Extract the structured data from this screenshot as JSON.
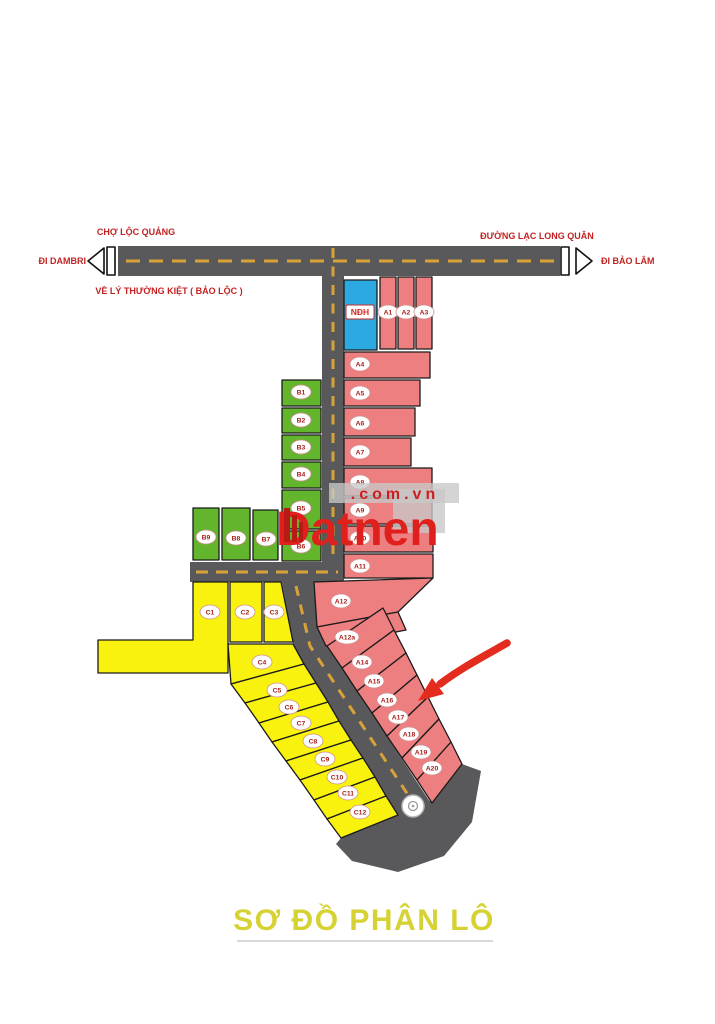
{
  "page_title": "SƠ ĐỒ PHÂN LÔ",
  "watermark": {
    "brand": "Datnen",
    "suffix": ".com.vn"
  },
  "streets": {
    "market": "CHỢ LỘC QUẢNG",
    "main_road": "ĐƯỜNG LẠC LONG QUÂN",
    "west_direction": "ĐI DAMBRI",
    "east_direction": "ĐI BẢO LÂM",
    "south_note": "VỀ LÝ THƯỜNG KIỆT ( BẢO LỘC )"
  },
  "plots": {
    "blue": [
      {
        "id": "NDH",
        "label": "NĐH"
      }
    ],
    "pink": [
      {
        "id": "A1",
        "label": "A1"
      },
      {
        "id": "A2",
        "label": "A2"
      },
      {
        "id": "A3",
        "label": "A3"
      },
      {
        "id": "A4",
        "label": "A4"
      },
      {
        "id": "A5",
        "label": "A5"
      },
      {
        "id": "A6",
        "label": "A6"
      },
      {
        "id": "A7",
        "label": "A7"
      },
      {
        "id": "A8",
        "label": "A8"
      },
      {
        "id": "A9",
        "label": "A9"
      },
      {
        "id": "A10",
        "label": "A10"
      },
      {
        "id": "A11",
        "label": "A11"
      },
      {
        "id": "A12",
        "label": "A12"
      },
      {
        "id": "A12a",
        "label": "A12a"
      },
      {
        "id": "A14",
        "label": "A14"
      },
      {
        "id": "A15",
        "label": "A15"
      },
      {
        "id": "A16",
        "label": "A16"
      },
      {
        "id": "A17",
        "label": "A17"
      },
      {
        "id": "A18",
        "label": "A18"
      },
      {
        "id": "A19",
        "label": "A19"
      },
      {
        "id": "A20",
        "label": "A20"
      }
    ],
    "green": [
      {
        "id": "B1",
        "label": "B1"
      },
      {
        "id": "B2",
        "label": "B2"
      },
      {
        "id": "B3",
        "label": "B3"
      },
      {
        "id": "B4",
        "label": "B4"
      },
      {
        "id": "B5",
        "label": "B5"
      },
      {
        "id": "B6",
        "label": "B6"
      },
      {
        "id": "B7",
        "label": "B7"
      },
      {
        "id": "B8",
        "label": "B8"
      },
      {
        "id": "B9",
        "label": "B9"
      }
    ],
    "yellow": [
      {
        "id": "C1",
        "label": "C1"
      },
      {
        "id": "C2",
        "label": "C2"
      },
      {
        "id": "C3",
        "label": "C3"
      },
      {
        "id": "C4",
        "label": "C4"
      },
      {
        "id": "C5",
        "label": "C5"
      },
      {
        "id": "C6",
        "label": "C6"
      },
      {
        "id": "C7",
        "label": "C7"
      },
      {
        "id": "C8",
        "label": "C8"
      },
      {
        "id": "C9",
        "label": "C9"
      },
      {
        "id": "C10",
        "label": "C10"
      },
      {
        "id": "C11",
        "label": "C11"
      },
      {
        "id": "C12",
        "label": "C12"
      }
    ]
  },
  "colors": {
    "blue": "#2ba9e0",
    "pink": "#ee7f81",
    "green": "#63b52d",
    "yellow": "#f8f20e",
    "road": "#59595b",
    "dash": "#d7a339",
    "street_text": "#c32222",
    "title": "#d6d234",
    "watermark": "#e0201c",
    "arrow": "#e32b1e"
  }
}
